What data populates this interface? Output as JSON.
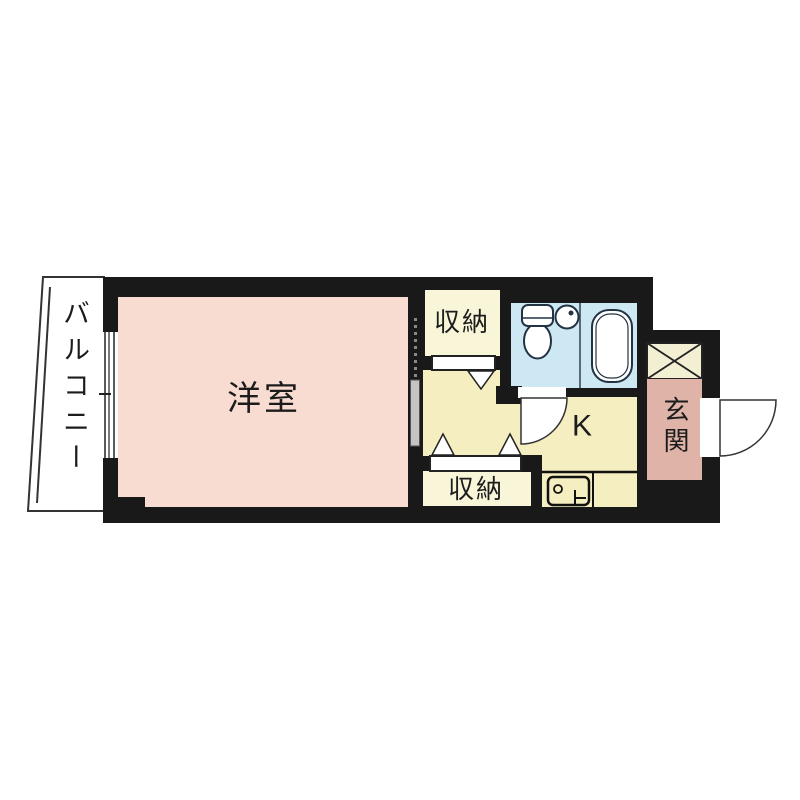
{
  "plan_type": "floor-plan",
  "labels": {
    "balcony": "バルコニー",
    "western_room": "洋室",
    "storage_upper": "収納",
    "storage_lower": "収納",
    "kitchen": "K",
    "entrance": "玄関"
  },
  "colors": {
    "wall": "#191919",
    "western_room": "#f8dcd1",
    "hall": "#f4eec0",
    "closet": "#f8f5d9",
    "crossed_box": "#f3efd3",
    "bath": "#cde7f3",
    "entrance": "#dfb3a8",
    "outline": "#222222",
    "sliding_door": "#c4c4c4"
  }
}
